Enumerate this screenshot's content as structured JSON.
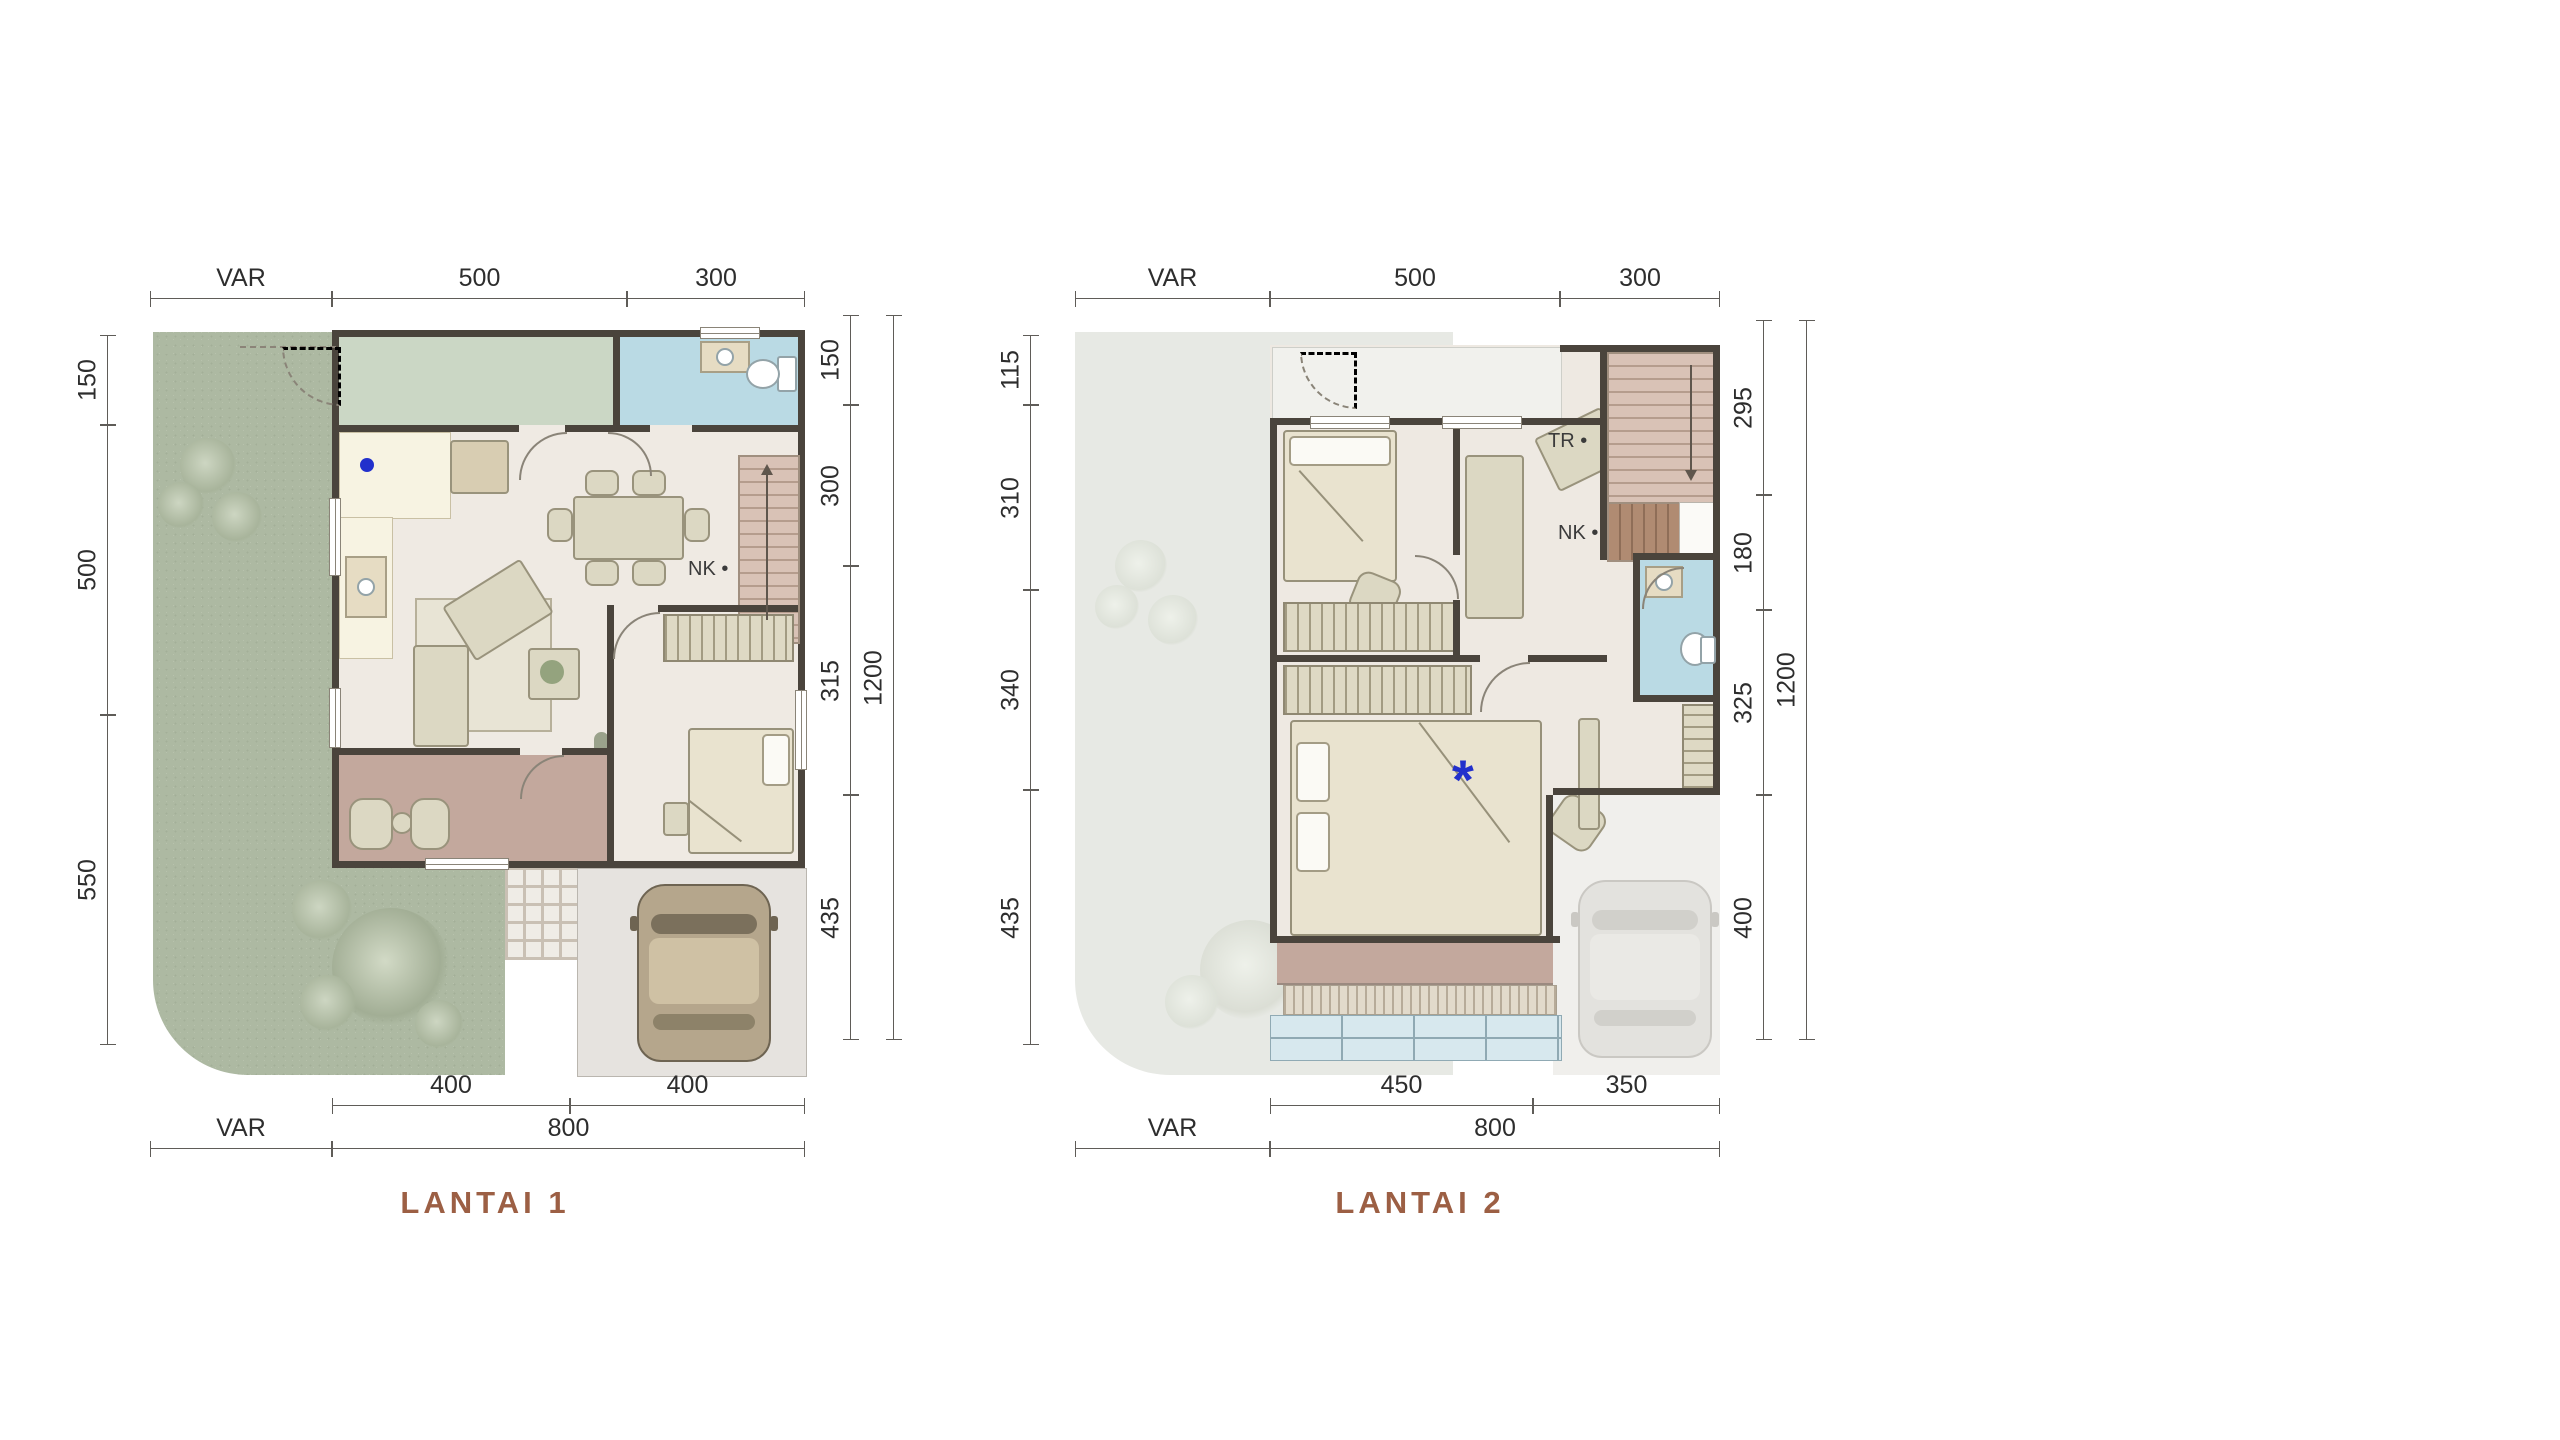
{
  "panel": {
    "size_label": "8X12",
    "name_line1": "PREMIUM 1",
    "name_line2": "HOOK ATTIC",
    "specs": [
      {
        "label": "LT :",
        "value": "VAR m²"
      },
      {
        "label": "LB :",
        "value": "161 m²"
      }
    ],
    "features": [
      {
        "icon": "bed-icon",
        "count": "3"
      },
      {
        "icon": "bath-icon",
        "count": "3"
      },
      {
        "icon": "car-icon",
        "count": "1"
      },
      {
        "icon": "attic-icon",
        "count": "1"
      }
    ]
  },
  "floor1": {
    "label": "LANTAI 1",
    "stair_label": "NK",
    "dims": {
      "top": [
        "VAR",
        "500",
        "300"
      ],
      "left": [
        "150",
        "500",
        "550"
      ],
      "right": [
        "150",
        "300",
        "315",
        "435"
      ],
      "right_total": "1200",
      "bottom_inner": [
        "400",
        "400"
      ],
      "bottom_outer": [
        "VAR",
        "800"
      ]
    }
  },
  "floor2": {
    "label": "LANTAI 2",
    "stair_labels": [
      "TR",
      "NK"
    ],
    "note_marker": "*",
    "dims": {
      "top": [
        "VAR",
        "500",
        "300"
      ],
      "left": [
        "115",
        "310",
        "340",
        "435"
      ],
      "right": [
        "295",
        "180",
        "325",
        "400"
      ],
      "right_total": "1200",
      "bottom_inner": [
        "450",
        "350"
      ],
      "bottom_outer": [
        "VAR",
        "800"
      ]
    }
  },
  "colors": {
    "accent": "#A5724F",
    "floor_label": "#9C5F44",
    "wall": "#4A443C",
    "garden_green": "#ADB9A2",
    "room_floor": "#EFEAE3",
    "room_green": "#CBD7C5",
    "bath_blue": "#BADAE4",
    "terrace_brown": "#C3A89D",
    "stairs_tan": "#D9C2B6",
    "marker_blue": "#2230CC"
  }
}
